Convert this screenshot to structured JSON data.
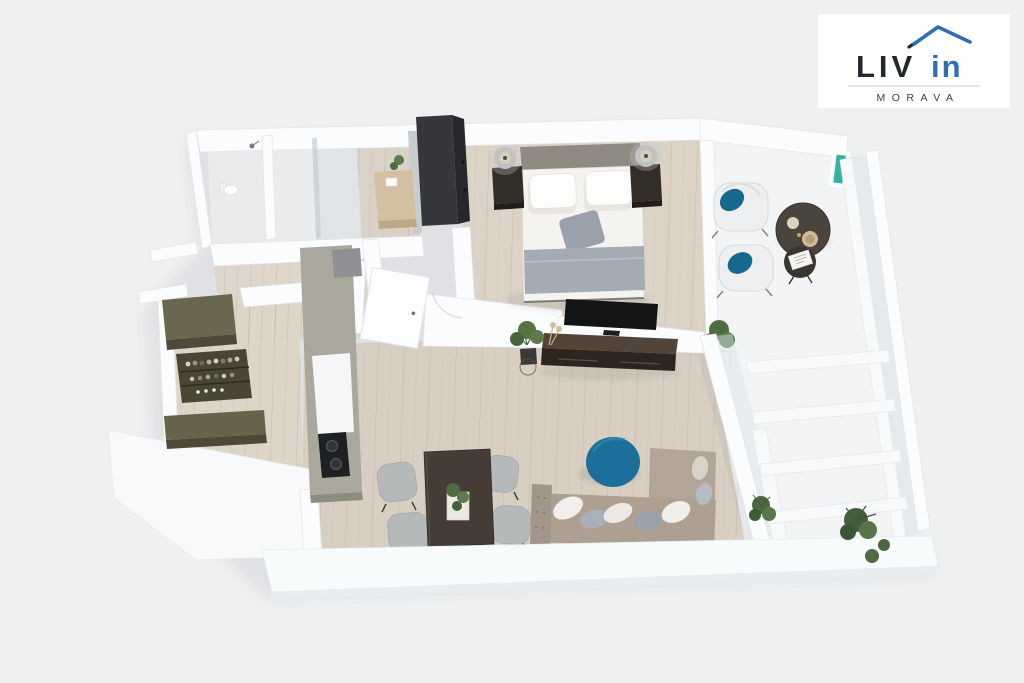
{
  "canvas": {
    "width": 1024,
    "height": 683,
    "background": "#eef0f1"
  },
  "logo": {
    "brand_primary": "LIV",
    "brand_accent": "in",
    "tagline": "MORAVA",
    "card_color": "#ffffff",
    "primary_color": "#23282f",
    "accent_color": "#2e6fb2",
    "tagline_color": "#3a4149"
  },
  "scene": {
    "type": "3d-apartment-floor-plan-render",
    "accent_teal": "#1b6f9a",
    "cushion_teal": "#16688c",
    "door_strip_teal": "#35b0a3",
    "wood_floor": "#d9d0c3",
    "wall_white": "#fbfcfd",
    "balcony_floor": "#f2f4f5",
    "dark_furniture": "#2e251e",
    "sofa_beige": "#ada092",
    "rooms": [
      "bathroom",
      "shower-room",
      "entry-corridor",
      "hallway",
      "kitchen",
      "bedroom",
      "living-room",
      "dining-area",
      "balcony"
    ],
    "furniture": [
      "double-bed",
      "nightstand-left",
      "nightstand-right",
      "bedside-lamps",
      "wardrobe",
      "desk",
      "tv",
      "tv-stand",
      "sofa",
      "teal-pouf",
      "dining-table",
      "dining-chairs",
      "kitchen-counter",
      "cooktop",
      "sink",
      "bar-shelf-with-bottles",
      "olive-cabinets",
      "balcony-armchairs",
      "balcony-round-table",
      "balcony-side-table",
      "potted-plants",
      "glass-railing",
      "toilet",
      "shower"
    ]
  }
}
